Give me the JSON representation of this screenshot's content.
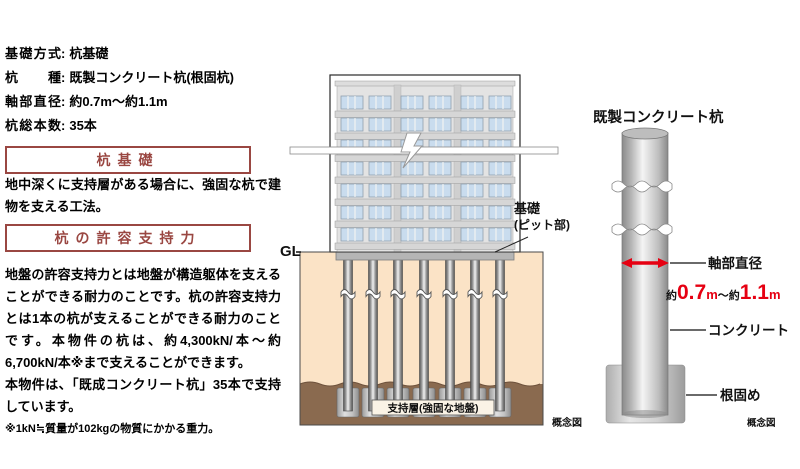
{
  "colors": {
    "header_red": "#9a4742",
    "accent_red": "#e60012",
    "soil_tan": "#fbe3c6",
    "support_brown": "#8a6a4f",
    "window_blue": "#c9dcee"
  },
  "specs": {
    "separator": ":",
    "rows": [
      {
        "label": "基礎方式",
        "value": "杭基礎"
      },
      {
        "label": "杭種",
        "value": "既製コンクリート杭(根固杭)"
      },
      {
        "label": "軸部直径",
        "value": "約0.7m～約1.1m"
      },
      {
        "label": "杭総本数",
        "value": "35本"
      }
    ]
  },
  "sections": [
    {
      "heading": "杭基礎",
      "body": "地中深くに支持層がある場合に、強固な杭で建物を支える工法。"
    },
    {
      "heading": "杭の許容支持力",
      "body": "地盤の許容支持力とは地盤が構造躯体を支えることができる耐力のことです。杭の許容支持力とは1本の杭が支えることができる耐力のことです。本物件の杭は、約4,300kN/本～約6,700kN/本※まで支えることができます。",
      "body2": "本物件は、「既成コンクリート杭」35本で支持しています。",
      "note": "※1kN≒質量が102kgの物質にかかる重力。"
    }
  ],
  "building_diagram": {
    "gl_label": "GL",
    "foundation_label_line1": "基礎",
    "foundation_label_line2": "(ピット部)",
    "support_layer_label": "支持層(強固な地盤)",
    "caption": "概念図"
  },
  "pile_diagram": {
    "title": "既製コンクリート杭",
    "diameter_label": "軸部直径",
    "diameter_value": {
      "prefix": "約",
      "v1": "0.7",
      "u1": "m",
      "mid": "～約",
      "v2": "1.1",
      "u2": "m"
    },
    "concrete_label": "コンクリート",
    "root_label": "根固め",
    "caption": "概念図"
  }
}
